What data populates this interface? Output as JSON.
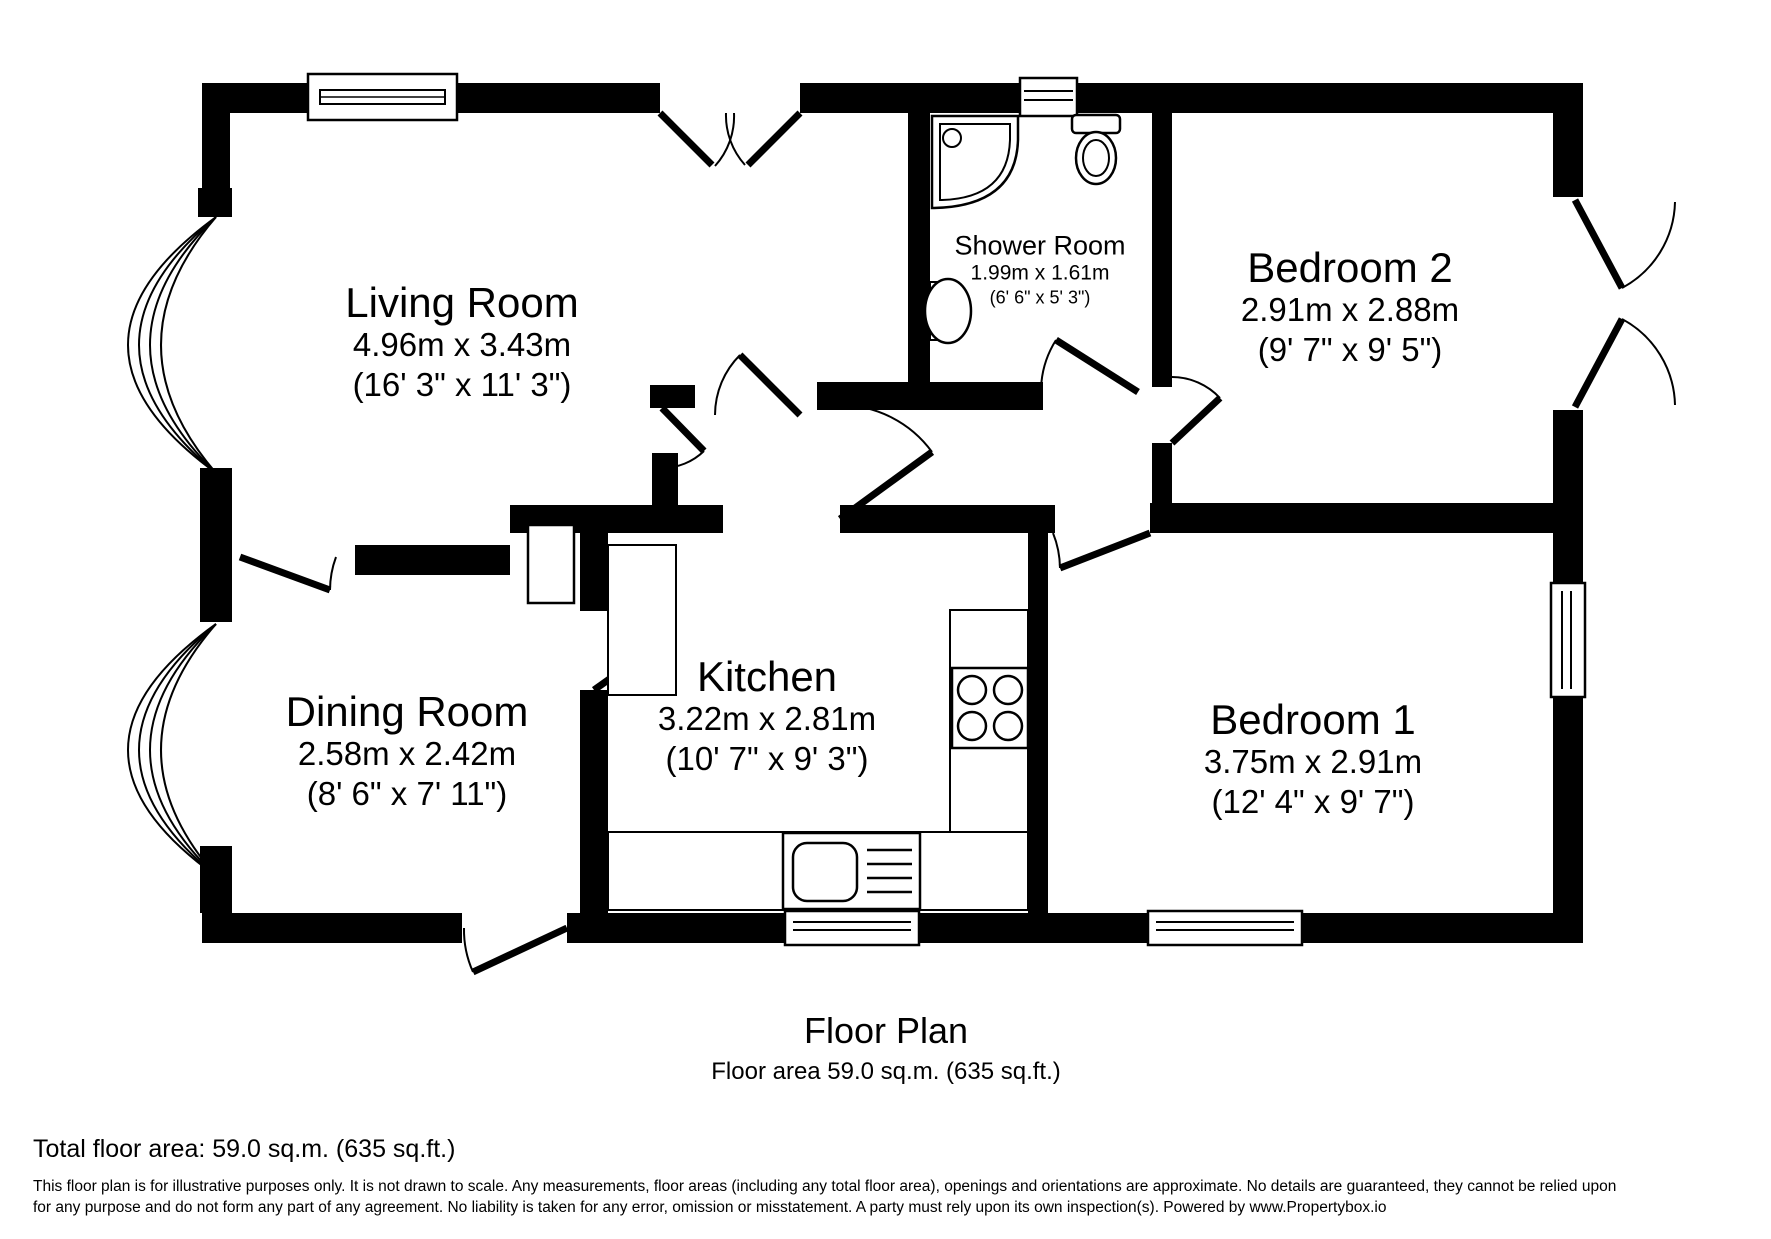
{
  "canvas": {
    "background": "#ffffff",
    "wall_color": "#000000",
    "line_color": "#000000"
  },
  "rooms": [
    {
      "id": "living-room",
      "name": "Living Room",
      "metric": "4.96m x 3.43m",
      "imperial": "(16' 3\" x 11' 3\")"
    },
    {
      "id": "shower-room",
      "name": "Shower Room",
      "metric": "1.99m x 1.61m",
      "imperial": "(6' 6\" x 5' 3\")"
    },
    {
      "id": "bedroom-2",
      "name": "Bedroom 2",
      "metric": "2.91m x 2.88m",
      "imperial": "(9' 7\" x 9' 5\")"
    },
    {
      "id": "dining-room",
      "name": "Dining Room",
      "metric": "2.58m x 2.42m",
      "imperial": "(8' 6\" x 7' 11\")"
    },
    {
      "id": "kitchen",
      "name": "Kitchen",
      "metric": "3.22m x 2.81m",
      "imperial": "(10' 7\" x 9' 3\")"
    },
    {
      "id": "bedroom-1",
      "name": "Bedroom 1",
      "metric": "3.75m x 2.91m",
      "imperial": "(12' 4\" x 9' 7\")"
    }
  ],
  "footer": {
    "title": "Floor Plan",
    "subtitle": "Floor area 59.0 sq.m. (635 sq.ft.)",
    "total": "Total floor area: 59.0 sq.m. (635 sq.ft.)",
    "disclaimer_line1": "This floor plan is for illustrative purposes only. It is not drawn to scale. Any measurements, floor areas (including any total floor area), openings and orientations are approximate. No details are guaranteed, they cannot be relied upon",
    "disclaimer_line2": "for any purpose and do not form any part of any agreement. No liability is taken for any error, omission or misstatement. A party must rely upon its own inspection(s). Powered by www.Propertybox.io"
  }
}
